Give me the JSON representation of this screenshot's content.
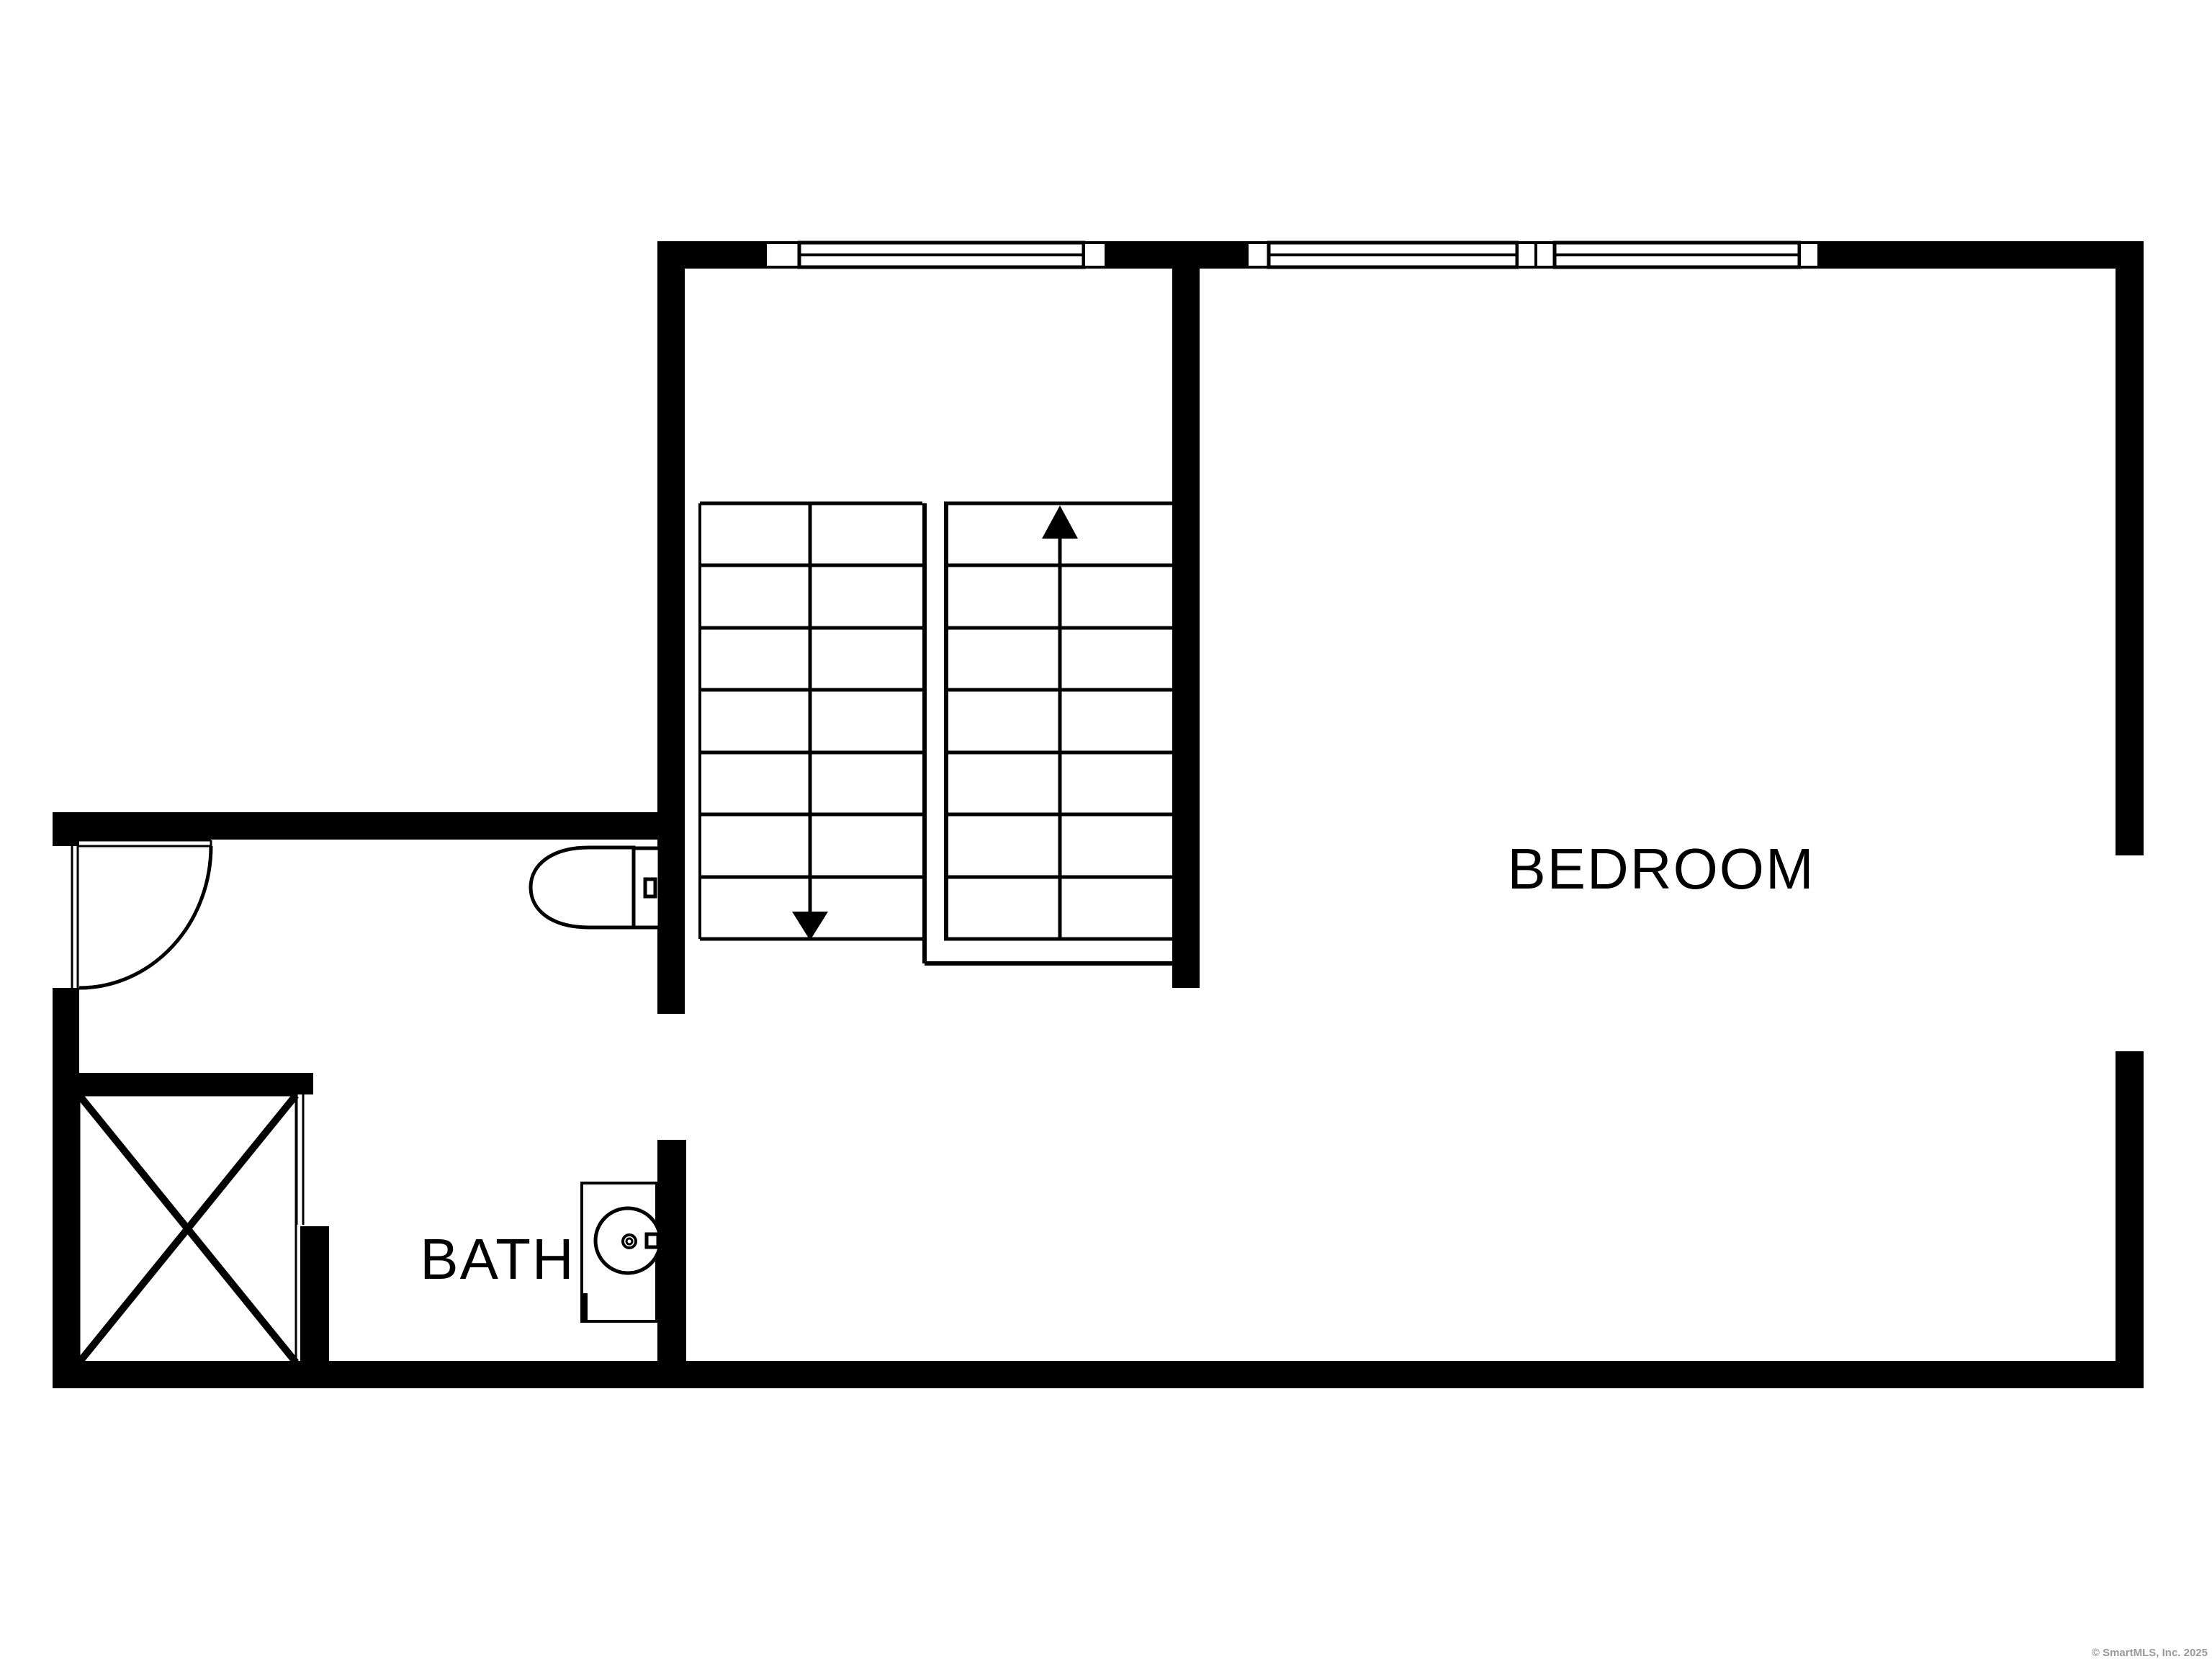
{
  "labels": {
    "bedroom": "BEDROOM",
    "bath": "BATH"
  },
  "watermark": {
    "text": "© SmartMLS, Inc. 2025",
    "color": "#999999"
  },
  "colors": {
    "background": "#ffffff",
    "wall": "#000000",
    "line": "#000000"
  }
}
